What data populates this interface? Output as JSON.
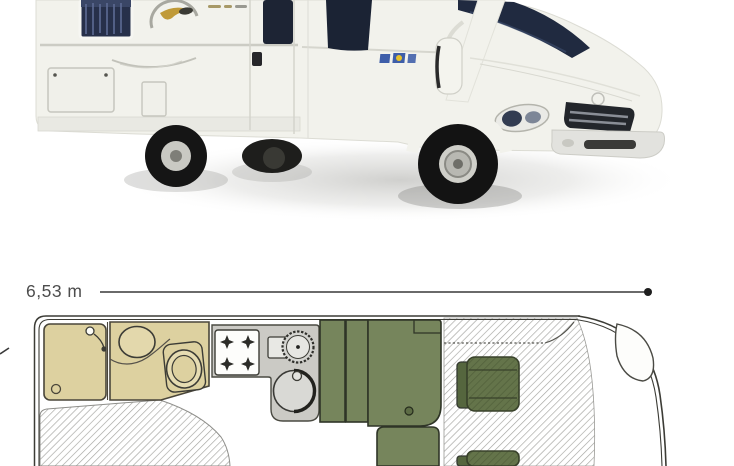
{
  "document": {
    "kind": "motorhome-brochure-panel",
    "background_color": "#ffffff"
  },
  "photo": {
    "subject": "motorhome-exterior-side-photo",
    "colors": {
      "body": "#f2f2ec",
      "glass": "#202a40",
      "grille": "#23262b",
      "tire": "#161616",
      "shadow": "#9b9b97",
      "decal_blue": "#2a4ea2",
      "decal_gold": "#c09a38"
    }
  },
  "floorplan": {
    "dimension_label": "6,53 m",
    "vehicle_length_m": 6.53,
    "colors": {
      "bathroom_tan": "#ddd1a0",
      "kitchen_gray": "#cbcac5",
      "furniture_green": "#76855c",
      "cab_seat_green": "#5c6b42",
      "outline_dark": "#3c3c36",
      "hatch_gray": "#a4a4a0",
      "dimension_text": "#4d4d4d"
    },
    "elements": [
      {
        "name": "dimension-line"
      },
      {
        "name": "shower-cubicle"
      },
      {
        "name": "shower-mixer-icon"
      },
      {
        "name": "washbasin"
      },
      {
        "name": "toilet"
      },
      {
        "name": "hob-4-burner"
      },
      {
        "name": "kitchen-tap"
      },
      {
        "name": "kitchen-round-sink-small"
      },
      {
        "name": "kitchen-round-sink-large"
      },
      {
        "name": "wardrobe"
      },
      {
        "name": "dinette-bench"
      },
      {
        "name": "dinette-side-seat"
      },
      {
        "name": "rear-bed-hatched"
      },
      {
        "name": "overcab-bed-hatched-floor"
      },
      {
        "name": "cab-seat-driver"
      },
      {
        "name": "cab-seat-passenger"
      },
      {
        "name": "front-body-outline"
      }
    ]
  }
}
